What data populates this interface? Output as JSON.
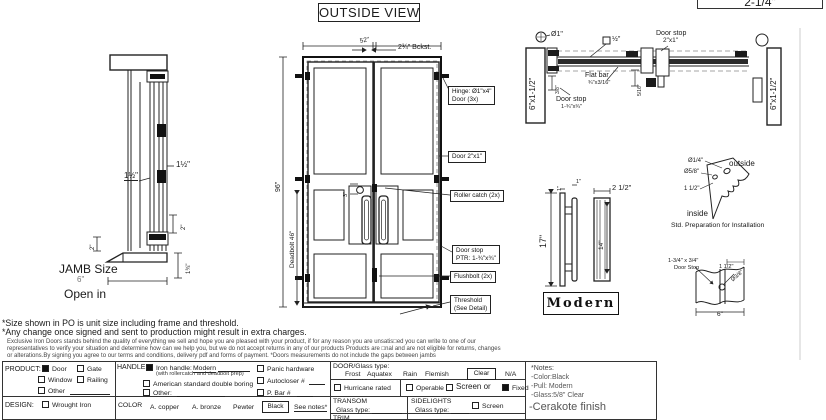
{
  "title": "OUTSIDE VIEW",
  "cropped_box": {
    "label": "2-1/4\""
  },
  "jamb": {
    "dim_inner": "1½\"",
    "dim_outer": "1½\"",
    "dim_left": "2\"",
    "dim_right_top": "2\"",
    "dim_right_bottom": "1¾\"",
    "label": "JAMB Size",
    "size": "6\"",
    "swing": "Open in"
  },
  "door": {
    "width": "52\"",
    "backset": "2¾\" Bckst.",
    "height": "96\"",
    "deadbolt": "Deadbolt 46\"",
    "lock_offset": "3\"",
    "hinge_l1": "Hinge: Ø1\"x4\"",
    "hinge_l2": "Door (3x)",
    "frame": "Door 2\"x1\"",
    "roller": "Roller catch  (2x)",
    "stop_l1": "Door stop",
    "stop_l2": "PTR: 1-¾\"x¾\"",
    "flushbolt": "Flushbolt (2x)",
    "threshold_l1": "Threshold",
    "threshold_l2": "(See Detail)"
  },
  "head": {
    "jamb_left": "6\"x1-1/2\"",
    "jamb_right": "6\"x1-1/2\"",
    "hinge_dia": "Ø1\"",
    "tube": "½\"",
    "stop1_l1": "Door stop",
    "stop1_l2": "2\"x1\"",
    "flat_l1": "Flat bar",
    "flat_l2": "¾\"x3/16\"",
    "stop2_l1": "Door stop",
    "stop2_l2": "1-¾\"x¾\"",
    "dim_a": "3/8\"",
    "dim_b": "5/16\""
  },
  "pull": {
    "height": "17\"",
    "dim_1a": "1\"",
    "dim_1b": "1\"",
    "top": "2 1/2\"",
    "grip": "14\"",
    "name": "Modern"
  },
  "prep": {
    "hole_small": "Ø1/4\"",
    "hole_big": "Ø5/8\"",
    "offset": "1 1/2\"",
    "outside": "outside",
    "inside": "inside",
    "caption": "Std. Preparation for Installation"
  },
  "stop_detail": {
    "size_l1": "1-3/4\" x 3/4\"",
    "size_l2": "Door Stop",
    "offset": "1 1/2\"",
    "hole": "Ø3/8\"",
    "width": "6\""
  },
  "disclaimer": {
    "line1": "*Size shown in PO is unit size including frame and threshold.",
    "line2": "*Any change once signed and sent to production might result in extra charges.",
    "p1": "Exclusive Iron Doors stands behind the quality of everything we sell and hope you are pleased with your product, if for any reason you are unsatis□ed you can write to one of our",
    "p2": "representatives to verify your situation and determine how can we help you, but we do not accept returns in any of our products Products are □nal and are not eligible for returns, changes",
    "p3": "or alterations.By signing you agree to our terms and conditions, delivery pdf and forms of payment. *Doors measurements do not include the gaps between jambs"
  },
  "form": {
    "product": {
      "label": "PRODUCT:",
      "door": "Door",
      "gate": "Gate",
      "window": "Window",
      "railing": "Railing",
      "other": "Other"
    },
    "design": {
      "label": "DESIGN:",
      "wrought": "Wrought Iron"
    },
    "handle": {
      "label": "HANDLE:",
      "iron": "Iron handle:",
      "iron_value": "Modern",
      "iron_note": "(with rollercatch and deadbolt prep)",
      "american": "American standard double boring",
      "other": "Other:",
      "panic": "Panic hardware",
      "autocloser": "Autocloser #",
      "pbar": "P. Bar #"
    },
    "color": {
      "label": "COLOR",
      "copper": "A. copper",
      "bronze": "A. bronze",
      "pewter": "Pewter",
      "black": "Black",
      "see_notes": "See notes*"
    },
    "glass": {
      "label": "DOOR/Glass type:",
      "frost": "Frost",
      "aquatex": "Aquatex",
      "rain": "Rain",
      "flemish": "Flemish",
      "clear": "Clear",
      "na": "N/A",
      "hurricane": "Hurricane rated",
      "operable": "Operable",
      "screen_or": "Screen or",
      "fixed": "Fixed"
    },
    "transom": {
      "label": "TRANSOM",
      "glass": "Glass type:"
    },
    "sidelights": {
      "label": "SIDELIGHTS",
      "glass": "Glass type:",
      "screen": "Screen"
    },
    "trim": {
      "label": "TRIM"
    },
    "notes": {
      "title": "*Notes:",
      "color": "-Color:Black",
      "pull": "-Pull: Modern",
      "glass": "-Glass:5/8\" Clear",
      "finish": "-Cerakote finish"
    }
  }
}
